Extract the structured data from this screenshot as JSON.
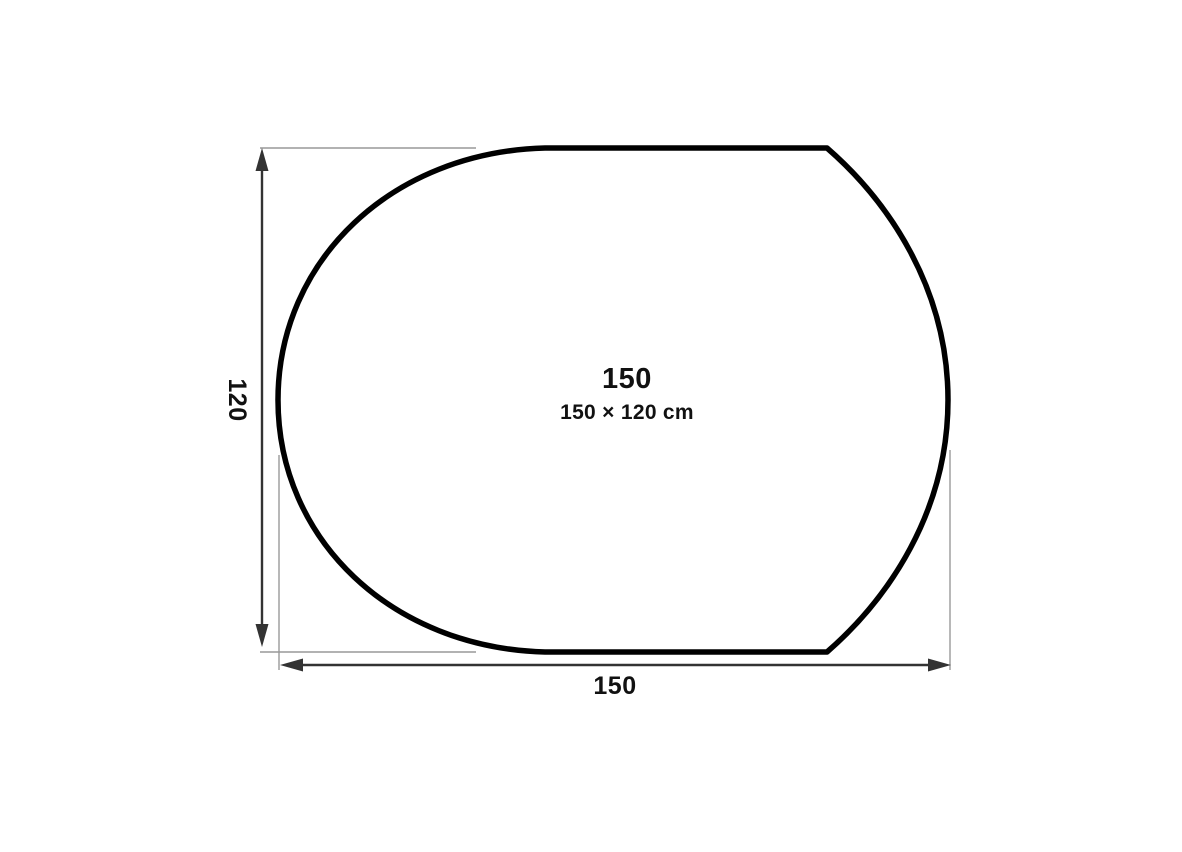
{
  "label": {
    "title": "150",
    "subtitle": "150 × 120 cm"
  },
  "dimensions": {
    "height_label": "120",
    "width_label": "150",
    "unit": "cm"
  },
  "colors": {
    "background": "#ffffff",
    "outline": "#000000",
    "dimension": "#333333",
    "extension": "#999999",
    "text": "#111111"
  }
}
